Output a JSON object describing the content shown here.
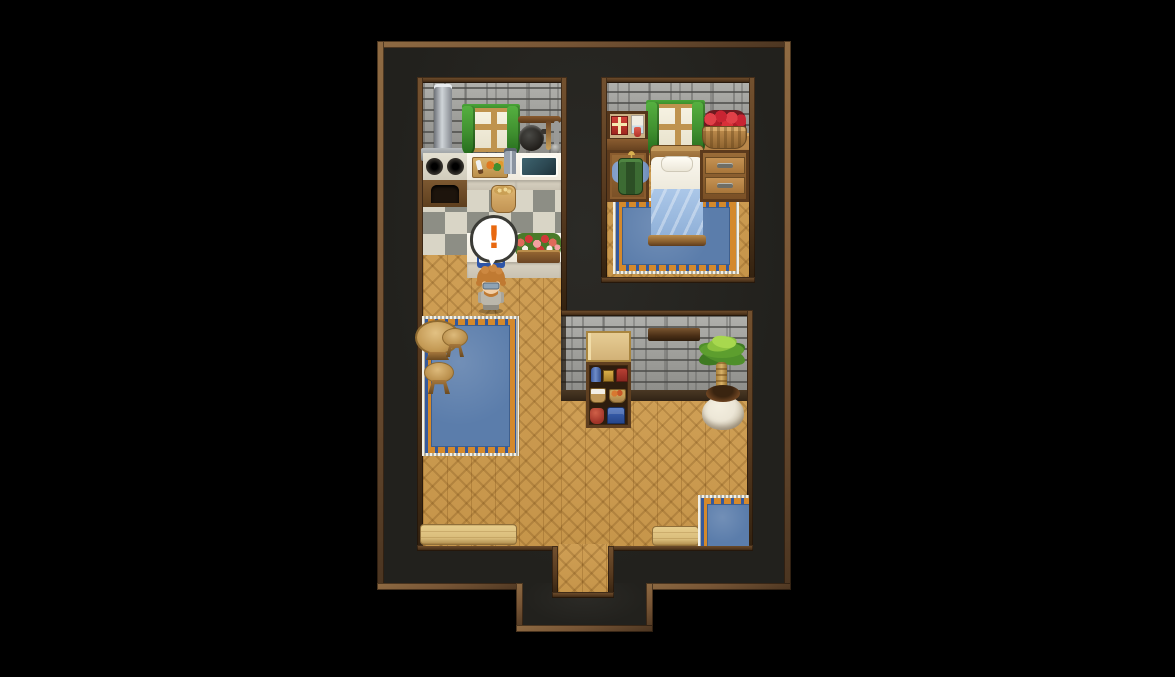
{
  "window": {
    "background": "#000000",
    "scene_type": "top-down RPG house interior map"
  },
  "palette": {
    "void": "#22211d",
    "frame_bronze": "#775535",
    "frame_bronze_light": "#8f6b43",
    "frame_bronze_dark": "#4a3420",
    "room_border": "#573a1f",
    "brick": "#9b9b97",
    "brick_mortar": "#6f6f6b",
    "wood_floor": "#c6954a",
    "checker_light": "#d9d5c6",
    "checker_dark": "#8d8e85",
    "counter_white": "#efeadd",
    "counter_face": "#d9d2c2",
    "carpet_blue": "#5b7dab",
    "carpet_orange": "#d4892c",
    "bench_wood": "#d9bc7a",
    "curtain_green": "#3f8f2f",
    "sink_water": "#2c4852",
    "blanket_blue": "#abc7e8",
    "apple_red": "#c82432",
    "plant_green": "#5d9e2e",
    "pot_cream": "#ece6d6",
    "hair_orange": "#c07a32",
    "balloon_mark": "#e8680f"
  },
  "balloon": {
    "symbol": "!"
  },
  "scene": {
    "rooms": [
      {
        "name": "kitchen",
        "objects": [
          "chimney-pipe",
          "stove-with-oven",
          "burners",
          "cutting-board-with-knife-and-vegetables",
          "spice-jars",
          "sink",
          "window-with-green-curtains",
          "utensil-rack",
          "frying-pan",
          "spatula",
          "ladle",
          "grain-sack",
          "checkered-tile-floor",
          "serving-counter",
          "open-blue-book",
          "flower-planter"
        ]
      },
      {
        "name": "bedroom",
        "objects": [
          "display-shelf",
          "gift-box",
          "picture-book",
          "red-vial",
          "window-with-green-curtains",
          "apple-basket",
          "wardrobe-with-hanging-tunic",
          "bed-with-blue-blanket",
          "dresser-two-drawers",
          "ornate-blue-rug",
          "parquet-floor"
        ]
      },
      {
        "name": "main-hall",
        "objects": [
          "round-table",
          "stool",
          "stool",
          "large-blue-carpet",
          "storage-shelf-with-jars-chests-baskets",
          "wall-shelf-plank",
          "potted-palm-plant",
          "wooden-bench-left",
          "wooden-bench-right",
          "small-blue-rug",
          "parquet-floor",
          "stone-wall"
        ]
      },
      {
        "name": "exit-corridor",
        "objects": [
          "parquet-floor",
          "doorway-south"
        ]
      }
    ],
    "character": {
      "description": "npc-orange-hair-glasses-beard-gray-robe",
      "state": "surprised",
      "balloon_symbol": "!"
    }
  }
}
